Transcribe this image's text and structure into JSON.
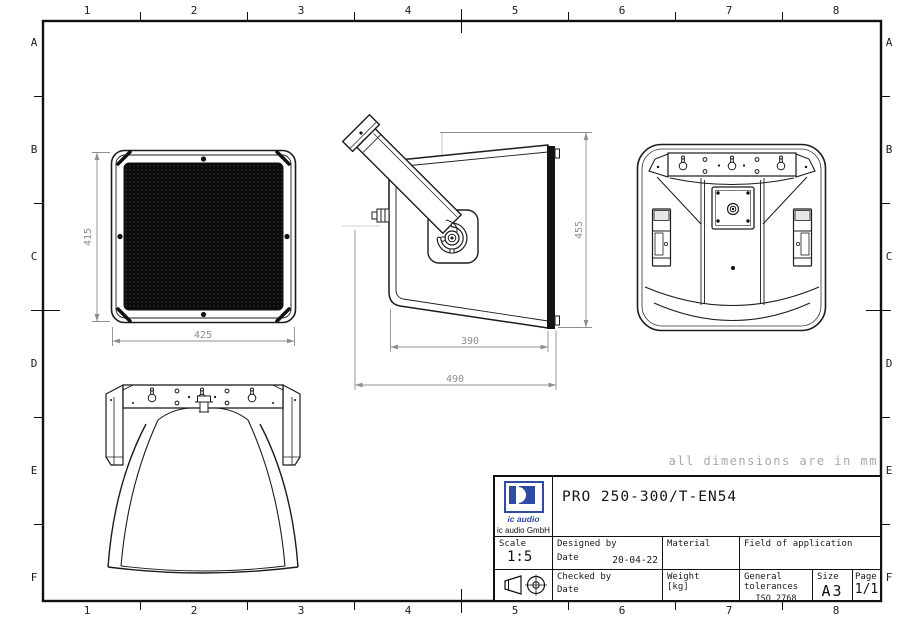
{
  "drawing": {
    "note": "all dimensions are in mm",
    "grid": {
      "cols": [
        "1",
        "2",
        "3",
        "4",
        "5",
        "6",
        "7",
        "8"
      ],
      "rows": [
        "A",
        "B",
        "C",
        "D",
        "E",
        "F"
      ]
    },
    "dimensions": {
      "front_height": "415",
      "front_width": "425",
      "side_depth": "390",
      "side_total_depth": "490",
      "side_height": "455"
    }
  },
  "title_block": {
    "product": "PRO 250-300/T-EN54",
    "logo_text": "ic audio",
    "company": "ic audio GmbH",
    "scale_label": "Scale",
    "scale_value": "1:5",
    "designed_label": "Designed by",
    "date_label": "Date",
    "designed_date": "20-04-22",
    "material_label": "Material",
    "field_label": "Field of application",
    "checked_label": "Checked by",
    "checked_date_label": "Date",
    "weight_label": "Weight",
    "weight_unit": "[kg]",
    "tolerances_label": "General tolerances",
    "tolerances_value": "ISO 2768 mittel",
    "size_label": "Size",
    "size_value": "A3",
    "page_label": "Page",
    "page_value": "1/1"
  }
}
